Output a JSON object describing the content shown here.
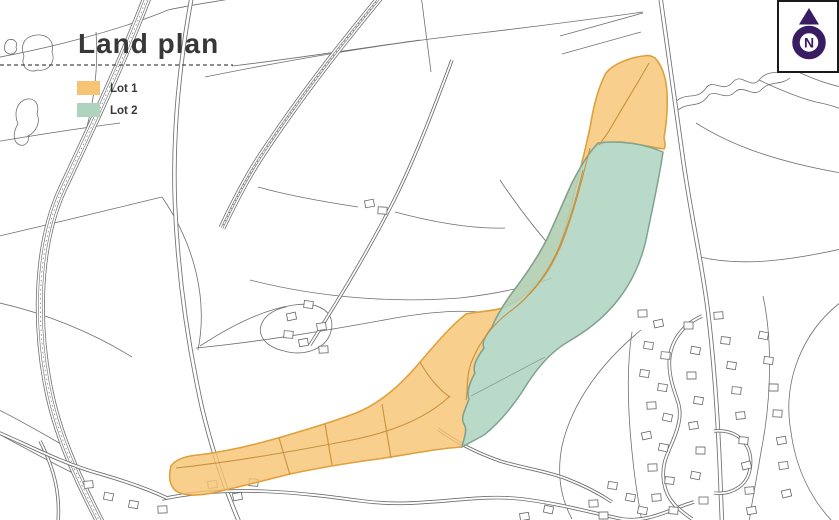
{
  "title": {
    "text": "Land plan",
    "color": "#383838"
  },
  "lots": {
    "lot1": {
      "label": "Lot 1",
      "fill": "#f6c473",
      "stroke": "#dfa03e",
      "inner_line": "#c8923e"
    },
    "lot2": {
      "label": "Lot 2",
      "fill": "#aed3bf",
      "stroke": "#7fa392"
    }
  },
  "north_marker": {
    "letter": "N",
    "color": "#381d63",
    "box_border": "#1a1a1a"
  },
  "map": {
    "line_color": "#6f6f6f",
    "background": "#ffffff"
  }
}
